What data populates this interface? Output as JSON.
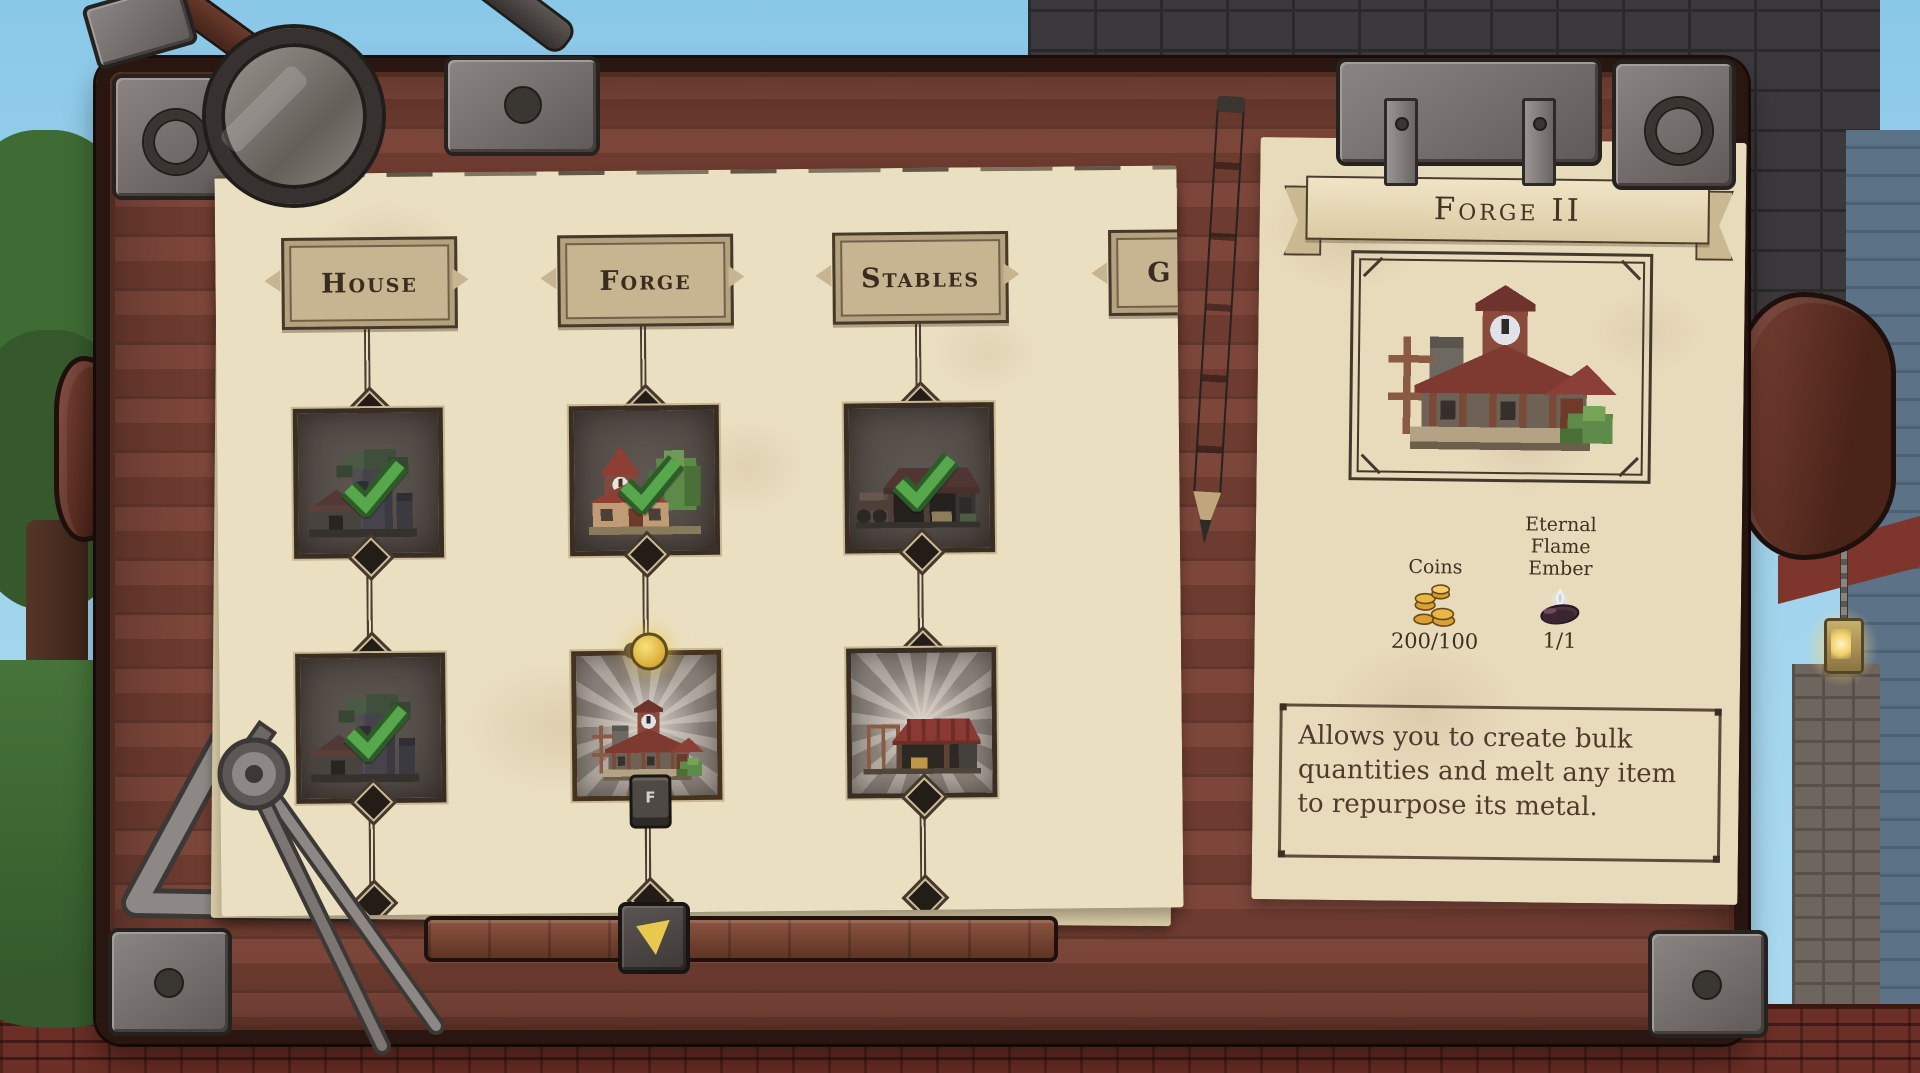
{
  "screen": "building-tech-tree",
  "columns": [
    {
      "label": "House",
      "tiers": [
        {
          "art": "ruined-tower",
          "status": "completed"
        },
        {
          "art": "ruined-tower",
          "status": "completed"
        }
      ]
    },
    {
      "label": "Forge",
      "tiers": [
        {
          "art": "village-forge",
          "status": "completed"
        },
        {
          "art": "forge-clocktower",
          "status": "selected",
          "key_hint": "F"
        }
      ]
    },
    {
      "label": "Stables",
      "tiers": [
        {
          "art": "barn-wagon",
          "status": "completed"
        },
        {
          "art": "barn-construction",
          "status": "available"
        }
      ]
    },
    {
      "label": "G"
    }
  ],
  "detail_panel": {
    "title": "Forge II",
    "art": "forge-clocktower",
    "costs": [
      {
        "name": "Coins",
        "icon": "coins-icon",
        "value": "200/100"
      },
      {
        "name": "Eternal Flame Ember",
        "icon": "ember-icon",
        "value": "1/1"
      }
    ],
    "description": "Allows you to create bulk quantities and melt any item to repurpose its metal."
  },
  "colors": {
    "accent_gold": "#d9a833",
    "check_green": "#57a84c",
    "paper": "#ebdfc1",
    "wood": "#73402f"
  }
}
